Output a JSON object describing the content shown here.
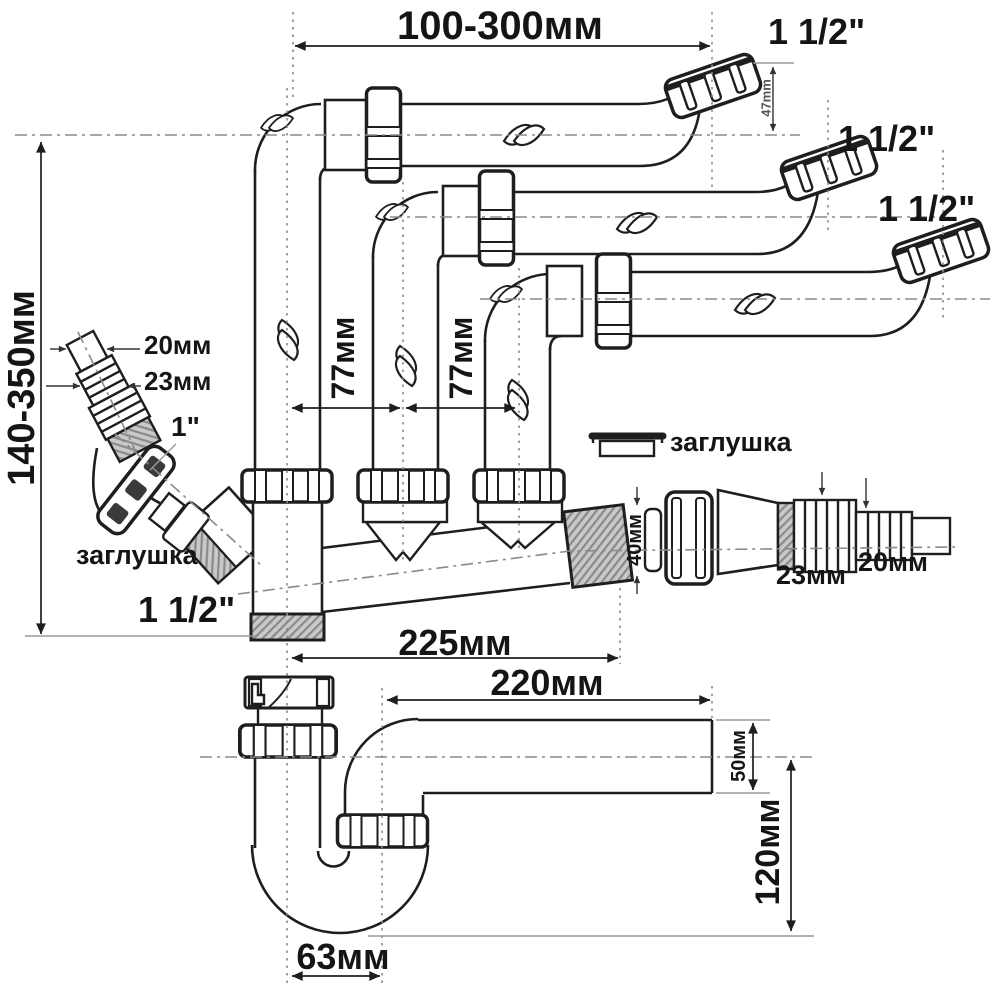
{
  "title": "Sink drain siphon installation diagram with dimensions",
  "colors": {
    "background": "#ffffff",
    "line": "#1e1e1e",
    "centerline": "#8a8a8a",
    "thread_fill": "#c9c9c9"
  },
  "labels": {
    "dim_top_span": "100-300мм",
    "outlet1_size": "1 1/2\"",
    "outlet2_size": "1 1/2\"",
    "outlet3_size": "1 1/2\"",
    "dim_outlet_offset": "47mm",
    "dim_left_height": "140-350мм",
    "dim_pipe_spacing_1": "77мм",
    "dim_pipe_spacing_2": "77мм",
    "dim_left_hose_tip": "20мм",
    "dim_left_hose": "23мм",
    "side_inlet_size": "1\"",
    "plug_left": "заглушка",
    "plug_right": "заглушка",
    "dim_washer": "40мм",
    "dim_right_hose": "23мм",
    "dim_right_hose_tip": "20мм",
    "bottom_outlet_size": "1 1/2\"",
    "dim_manifold_length": "225мм",
    "dim_outlet_pipe_length": "220мм",
    "dim_outlet_pipe_height": "50мм",
    "dim_trap_drop": "120мм",
    "dim_trap_width": "63мм"
  }
}
